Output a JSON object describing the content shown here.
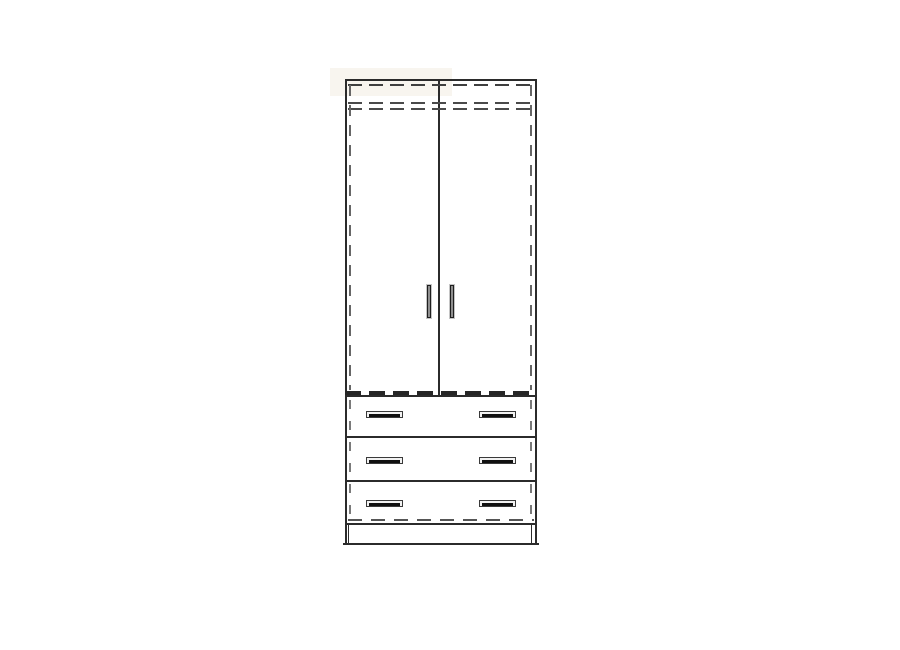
{
  "document": {
    "kind": "furniture technical line drawing",
    "subject": "tall two-door wardrobe with three lower drawers on a plinth",
    "view": "front elevation"
  },
  "wardrobe": {
    "doors": {
      "count": 2,
      "handles": 2,
      "handle_style": "vertical bar"
    },
    "drawers": {
      "count": 3,
      "handles_per_drawer": 2,
      "handle_style": "horizontal bar"
    },
    "plinth": {
      "present": true
    },
    "hidden_edges": "drawn as dashed lines (carcass sides, top panel, shelf, bottom panel)"
  },
  "colors": {
    "background": "#ffffff",
    "line": "#2b2b2b",
    "hidden": "#4d4d4d",
    "hidden_light": "#6e6e6e",
    "handle_frame": "#c4c4c4",
    "handle_dark": "#1f1f1f",
    "handle_face": "#f2f2f2",
    "handle_slot": "#101010",
    "shade": "#f5f1e9"
  }
}
